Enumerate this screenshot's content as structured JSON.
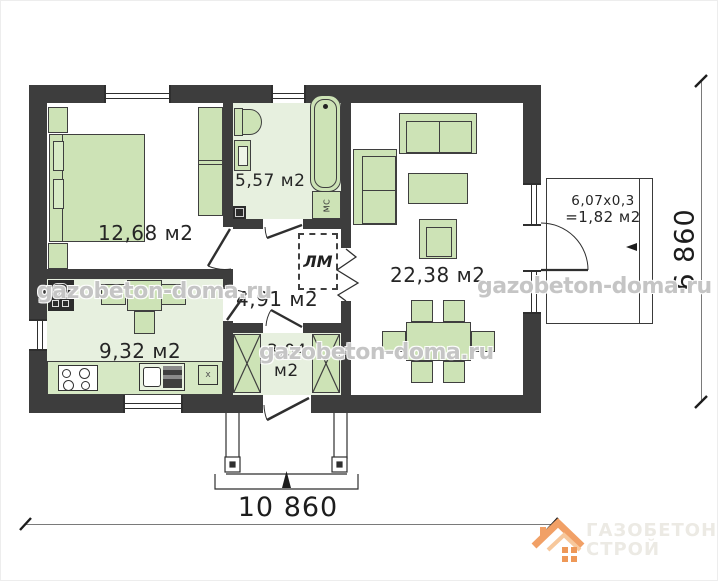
{
  "watermark": {
    "text": "gazobeton-doma.ru"
  },
  "logo": {
    "line1": "ГАЗОБЕТОН",
    "line2": "СТРОЙ"
  },
  "dimensions": {
    "overall_width": "10 860",
    "overall_depth": "6 860"
  },
  "rooms": {
    "bedroom": {
      "area": "12,68 м2"
    },
    "bathroom": {
      "area": "5,57 м2",
      "boiler_label": "МС"
    },
    "living_room": {
      "area": "22,38 м2"
    },
    "hallway": {
      "area": "4,91 м2",
      "attic_ladder_label": "ЛМ"
    },
    "kitchen": {
      "area": "9,32 м2",
      "vent_label": "x"
    },
    "entry": {
      "area_value": "3,04",
      "area_unit": "м2"
    },
    "terrace": {
      "dimensions_label": "6,07x0,3",
      "area_label": "=1,82 м2"
    }
  },
  "colors": {
    "wall": "#3d3d3d",
    "furniture_fill": "#cde3b6",
    "tinted_floor": "#e7f0df",
    "logo_accent": "#f1a066",
    "watermark_gray": "#969696"
  }
}
